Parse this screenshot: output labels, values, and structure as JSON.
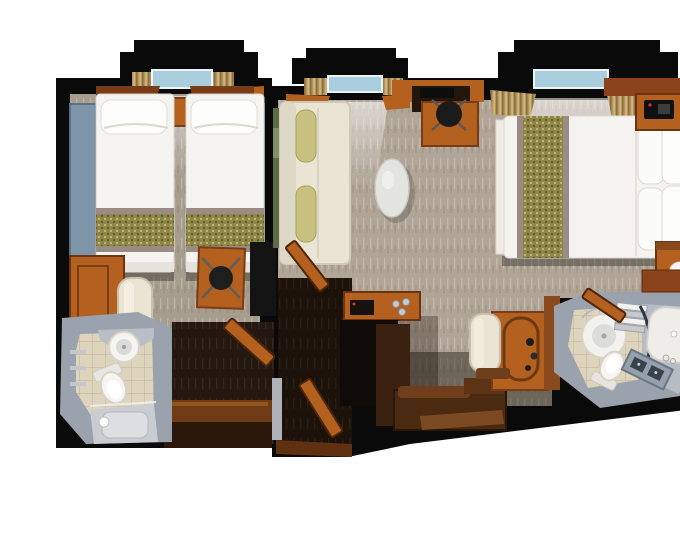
{
  "image": {
    "type": "floor-plan-render",
    "title": "Two-Bedroom Suite Floor Plan",
    "description": "Top-down 3D rendered floor plan of a two-bedroom suite: a twin-bed room with private bathroom on the left, an entry vestibule with open wooden connecting doors in the middle, and a main cabin on the right with living area (sofa, oval table, writing desk), double bed with runner and pillows, coffee console, lounge bench, vanity, and a master bathroom with round shower, bathtub, double sink and toilet. No text is visible in the image.",
    "visible_text": []
  },
  "palette": {
    "background": "#ffffff",
    "wall": "#0a0a0a",
    "wood": "#b4611f",
    "woodDark": "#7a3c16",
    "woodDeep": "#46230c",
    "carpetLeft": "#a79d8f",
    "carpetMain": "#b0a596",
    "darkFloor": "#241810",
    "panelBlue": "#7e94a8",
    "bedWhite": "#f4f3f0",
    "runnerOlive": "#8f8747",
    "runnerMauve": "#9a8c84",
    "sofaCream": "#e9e4d4",
    "bolsterOlive": "#c8c07e",
    "bathGray": "#99a2ad",
    "tileBeige": "#ded4bb",
    "fixtureWhite": "#f5f4f0",
    "windowBlue": "#a9cedd",
    "curtainGold": "#b2955e",
    "artGreen": "#5c6b4a"
  },
  "rooms": {
    "twin_bedroom": {
      "name": "Twin bedroom",
      "furniture": [
        "twin bed",
        "twin bed",
        "nightstand",
        "window",
        "vanity desk",
        "armchair",
        "desk with chair",
        "tv panel",
        "headboard panels"
      ]
    },
    "twin_bathroom": {
      "name": "Twin bathroom",
      "furniture": [
        "washbasin",
        "toilet",
        "shower",
        "wall shelves"
      ]
    },
    "vestibule": {
      "name": "Entry vestibule",
      "furniture": [
        "connecting door",
        "connecting door",
        "entry door",
        "luggage console"
      ]
    },
    "living_area": {
      "name": "Living area",
      "furniture": [
        "sofa",
        "bolster pillows",
        "oval table",
        "writing desk",
        "desk chair",
        "window",
        "wall artwork",
        "coffee console",
        "espresso machine",
        "lounge bench"
      ]
    },
    "master_bedroom": {
      "name": "Master bedroom",
      "furniture": [
        "double bed",
        "bed runner",
        "pillows",
        "headboard",
        "nightstand",
        "nightstand",
        "table lamp",
        "table lamp",
        "telephone",
        "window",
        "vanity table",
        "vanity chair",
        "wood canopy"
      ]
    },
    "master_bathroom": {
      "name": "Master bathroom",
      "furniture": [
        "round shower",
        "bathtub",
        "double sink counter",
        "toilet",
        "towel shelf",
        "door"
      ]
    }
  }
}
